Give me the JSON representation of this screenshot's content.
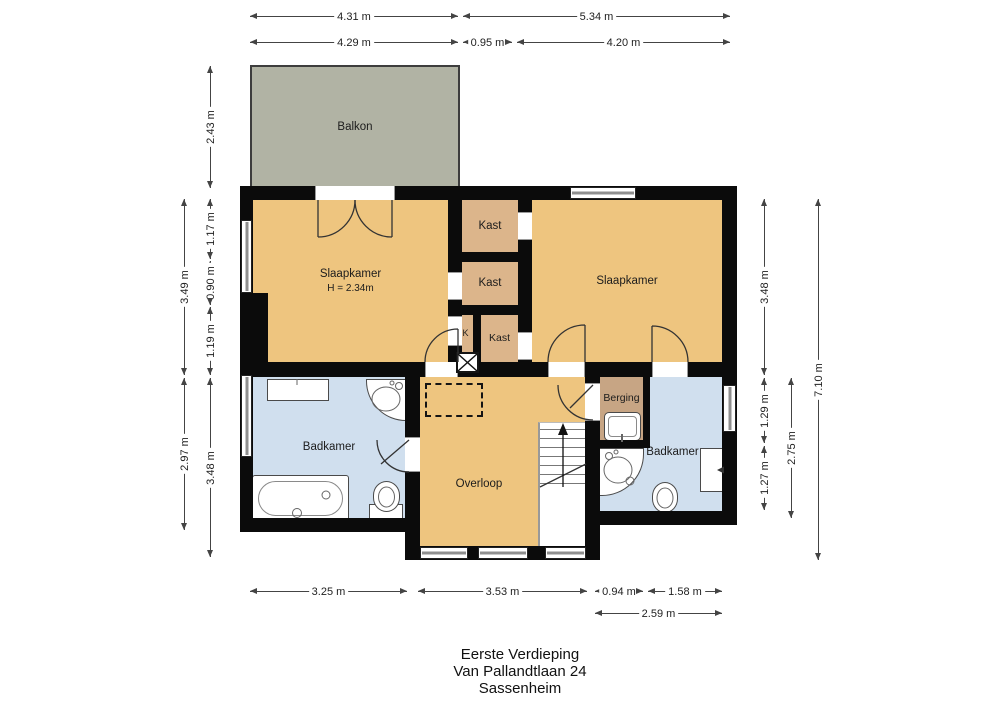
{
  "title_block": {
    "floor": "Eerste Verdieping",
    "address": "Van Pallandtlaan 24",
    "city": "Sassenheim"
  },
  "rooms": {
    "balkon": {
      "label": "Balkon"
    },
    "slaapkamer_left": {
      "label": "Slaapkamer",
      "sublabel": "H = 2.34m"
    },
    "slaapkamer_right": {
      "label": "Slaapkamer"
    },
    "kast_top": {
      "label": "Kast"
    },
    "kast_mid": {
      "label": "Kast"
    },
    "kast_bottom": {
      "label": "Kast"
    },
    "k_shaft": {
      "label": "K"
    },
    "badkamer_left": {
      "label": "Badkamer"
    },
    "badkamer_right": {
      "label": "Badkamer"
    },
    "overloop": {
      "label": "Overloop"
    },
    "berging": {
      "label": "Berging"
    }
  },
  "dimensions": {
    "top": {
      "w431": "4.31 m",
      "w534": "5.34 m",
      "w429": "4.29 m",
      "w095": "0.95 m",
      "w420": "4.20 m"
    },
    "left": {
      "h243": "2.43 m",
      "h349": "3.49 m",
      "h117": "1.17 m",
      "h090": "0.90 m",
      "h119": "1.19 m",
      "h297": "2.97 m",
      "h348": "3.48 m"
    },
    "right": {
      "h348": "3.48 m",
      "h129": "1.29 m",
      "h127": "1.27 m",
      "h275": "2.75 m",
      "h710": "7.10 m"
    },
    "bottom": {
      "w325": "3.25 m",
      "w353": "3.53 m",
      "w094": "0.94 m",
      "w158": "1.58 m",
      "w259": "2.59 m"
    }
  },
  "colors": {
    "wall": "#0b0b0b",
    "room-orange": "#eec57f",
    "closet-tan": "#dcb58b",
    "berging-tan": "#c7a584",
    "balcony-green": "#b1b3a4",
    "bathroom-blue": "#d0dfee",
    "window-gray": "#8f8f8f",
    "text": "#1c1c1c"
  }
}
